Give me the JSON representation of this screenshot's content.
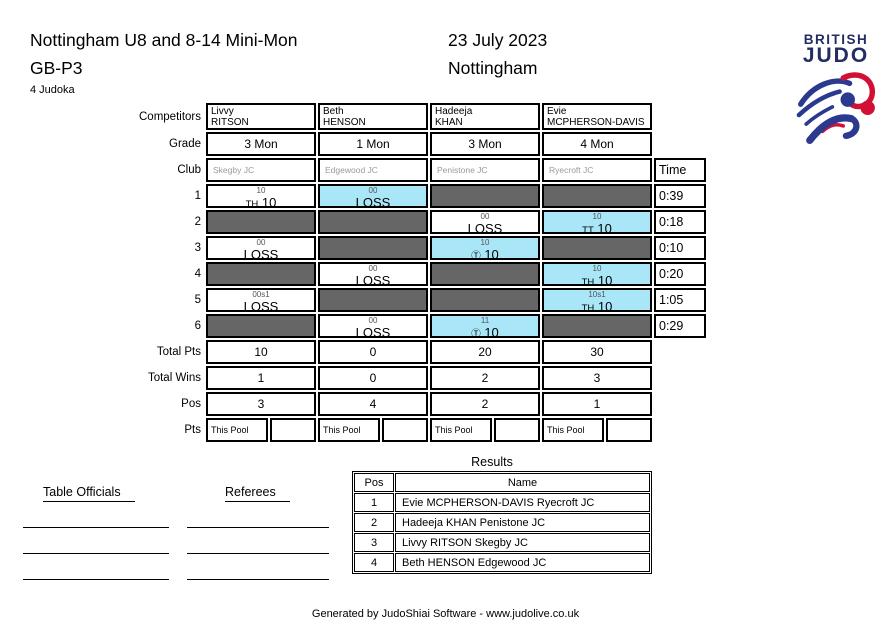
{
  "header": {
    "title": "Nottingham U8 and 8-14 Mini-Mon",
    "pool_code": "GB-P3",
    "date": "23 July 2023",
    "location": "Nottingham",
    "judoka_count": "4 Judoka"
  },
  "logo": {
    "line1": "BRITISH",
    "line2": "JUDO"
  },
  "colors": {
    "win_highlight": "#a8e6f8",
    "inactive_cell": "#666666",
    "accent_navy": "#232d64",
    "logo_red": "#d21034",
    "logo_blue": "#2b3a8f"
  },
  "pool": {
    "row_labels": {
      "competitors": "Competitors",
      "grade": "Grade",
      "club": "Club",
      "total_pts": "Total Pts",
      "total_wins": "Total Wins",
      "pos": "Pos",
      "pts": "Pts"
    },
    "time_header": "Time",
    "pts_box_label": "This Pool",
    "competitors": [
      {
        "first": "Livvy",
        "last": "RITSON",
        "grade": "3 Mon",
        "club": "Skegby JC"
      },
      {
        "first": "Beth",
        "last": "HENSON",
        "grade": "1 Mon",
        "club": "Edgewood JC"
      },
      {
        "first": "Hadeeja",
        "last": "KHAN",
        "grade": "3 Mon",
        "club": "Penistone JC"
      },
      {
        "first": "Evie",
        "last": "MCPHERSON-DAVIS",
        "grade": "4 Mon",
        "club": "Ryecroft JC"
      }
    ],
    "matches": [
      {
        "no": "1",
        "time": "0:39",
        "cells": [
          {
            "state": "win",
            "sub": "10",
            "tag": "TH",
            "score": "10"
          },
          {
            "state": "lose-hl",
            "sub": "00",
            "tag": "",
            "score": "LOSS"
          },
          {
            "state": "off"
          },
          {
            "state": "off"
          }
        ]
      },
      {
        "no": "2",
        "time": "0:18",
        "cells": [
          {
            "state": "off"
          },
          {
            "state": "off"
          },
          {
            "state": "lose",
            "sub": "00",
            "tag": "",
            "score": "LOSS"
          },
          {
            "state": "win-hl",
            "sub": "10",
            "tag": "TT",
            "score": "10"
          }
        ]
      },
      {
        "no": "3",
        "time": "0:10",
        "cells": [
          {
            "state": "lose",
            "sub": "00",
            "tag": "",
            "score": "LOSS"
          },
          {
            "state": "off"
          },
          {
            "state": "win-hl",
            "sub": "10",
            "tag": "Ⓣ",
            "score": "10"
          },
          {
            "state": "off"
          }
        ]
      },
      {
        "no": "4",
        "time": "0:20",
        "cells": [
          {
            "state": "off"
          },
          {
            "state": "lose",
            "sub": "00",
            "tag": "",
            "score": "LOSS"
          },
          {
            "state": "off"
          },
          {
            "state": "win-hl",
            "sub": "10",
            "tag": "TH",
            "score": "10"
          }
        ]
      },
      {
        "no": "5",
        "time": "1:05",
        "cells": [
          {
            "state": "lose",
            "sub": "00s1",
            "tag": "",
            "score": "LOSS"
          },
          {
            "state": "off"
          },
          {
            "state": "off"
          },
          {
            "state": "win-hl",
            "sub": "10s1",
            "tag": "TH",
            "score": "10"
          }
        ]
      },
      {
        "no": "6",
        "time": "0:29",
        "cells": [
          {
            "state": "off"
          },
          {
            "state": "lose",
            "sub": "00",
            "tag": "",
            "score": "LOSS"
          },
          {
            "state": "win-hl",
            "sub": "11",
            "tag": "Ⓣ",
            "score": "10"
          },
          {
            "state": "off"
          }
        ]
      }
    ],
    "total_pts": [
      "10",
      "0",
      "20",
      "30"
    ],
    "total_wins": [
      "1",
      "0",
      "2",
      "3"
    ],
    "positions": [
      "3",
      "4",
      "2",
      "1"
    ]
  },
  "results": {
    "title": "Results",
    "columns": {
      "pos": "Pos",
      "name": "Name"
    },
    "rows": [
      {
        "pos": "1",
        "name": "Evie MCPHERSON-DAVIS Ryecroft JC"
      },
      {
        "pos": "2",
        "name": "Hadeeja KHAN Penistone JC"
      },
      {
        "pos": "3",
        "name": "Livvy RITSON Skegby JC"
      },
      {
        "pos": "4",
        "name": "Beth HENSON Edgewood JC"
      }
    ]
  },
  "officials": {
    "table_officials_label": "Table Officials",
    "referees_label": "Referees"
  },
  "footer": {
    "credit": "Generated by JudoShiai Software - www.judolive.co.uk"
  }
}
